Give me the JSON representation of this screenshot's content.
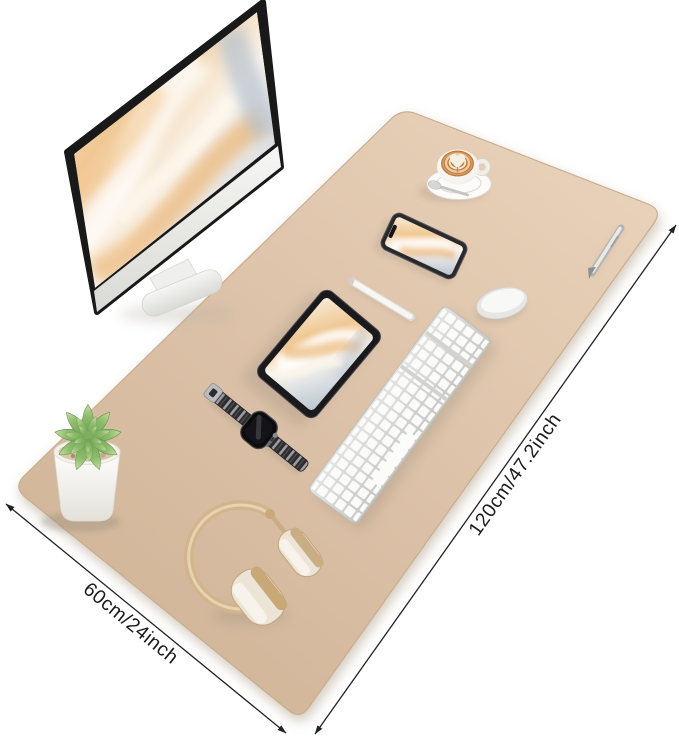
{
  "product_image": {
    "description": "Beige desk mat product photo with workspace items and size annotations",
    "annotations": {
      "length_label": "120cm/47.2inch",
      "depth_label": "60cm/24inch"
    },
    "colors": {
      "background": "#ffffff",
      "mat": "#dcc3ab",
      "mat_light": "#e9d2ba",
      "mat_dark": "#cfb396",
      "annotation_line": "#222222",
      "headphones_gold": "#d3b58c",
      "succulent_green": "#8cbb6c",
      "latte_orange": "#c07a3c"
    },
    "items": [
      "desk-mat",
      "monitor",
      "coffee-cup-latte",
      "smartphone",
      "stylus-pencil",
      "silver-pen",
      "magic-mouse",
      "tablet",
      "keyboard",
      "smartwatch",
      "succulent-plant",
      "headphones"
    ]
  }
}
